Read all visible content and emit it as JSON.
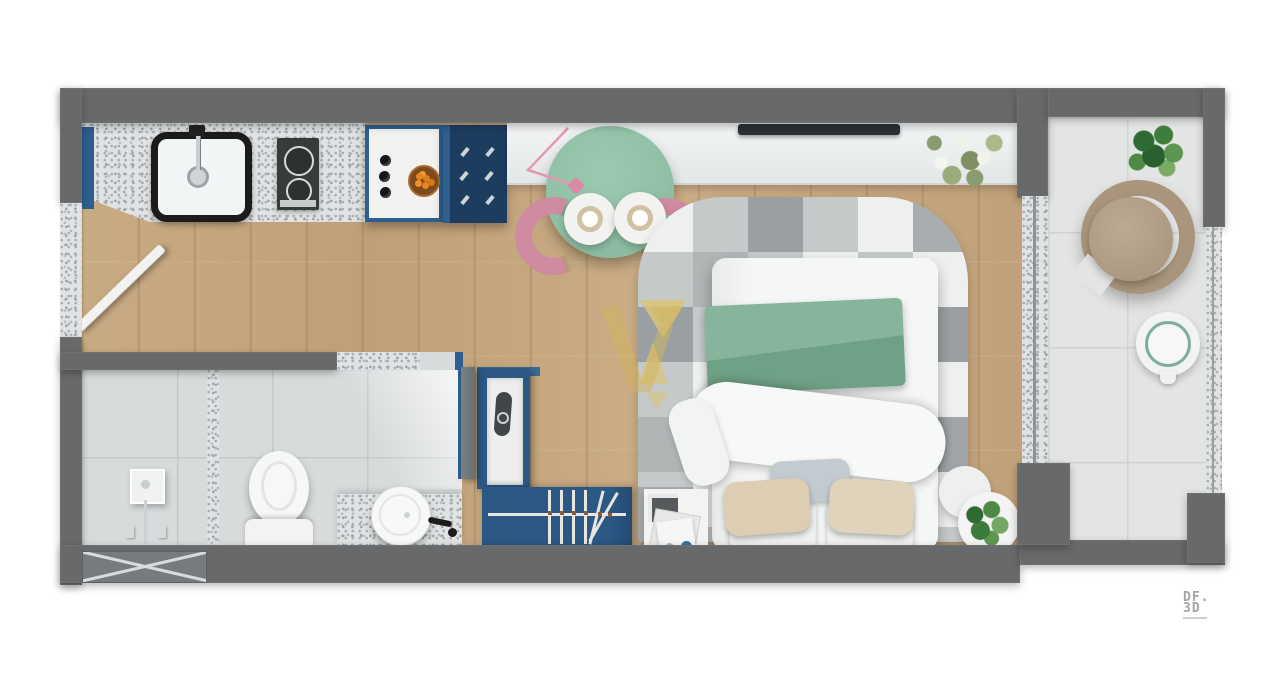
{
  "scene": {
    "type": "studio apartment floor plan, top-down 3D render",
    "rooms": [
      "kitchen",
      "dining area",
      "bedroom",
      "bathroom",
      "wardrobe corridor",
      "balcony"
    ],
    "furniture": [
      "kitchen sink with black faucet",
      "two-burner cooktop",
      "blue island unit with knobs and fruit bowl",
      "navy cabinet with handles",
      "round green dining table with two plates",
      "two pink chairs",
      "pink pendant lamp",
      "white console with TV",
      "white flower plant",
      "checkered gray rug with yellow triangles",
      "double bed with green blanket and pillows",
      "round bedside tables with plant",
      "magazine board",
      "blue wardrobe with hanger rail",
      "shelf with hair dryer",
      "shower set",
      "toilet",
      "granite counter with round washbasin and black faucet",
      "open entry door",
      "open bathroom door",
      "hatched window opening",
      "round rattan lounge chair",
      "round white side table",
      "balcony plant"
    ]
  },
  "logo": {
    "line1": "DF.",
    "line2": "3D"
  },
  "watermark": {
    "name": "yellow V brand watermark"
  },
  "colors": {
    "wall": "#67696b",
    "granite": "#e0e2e3",
    "wood": "#c6a87f",
    "bath_tile": "#d8dbdc",
    "balcony_tile": "#e3e5e4",
    "tile_line": "#cfd2d1",
    "navy": "#1d3d60",
    "blue": "#2e5f8e",
    "wardrobe_blue": "#2b5884",
    "table_green": "#8cbfa4",
    "chair_pink": "#cf8ba0",
    "lamp_pink": "#d98ba6",
    "blanket_green": "#7cac92",
    "rug_light": "#eef0f0",
    "rug_mid": "#c5c9ca",
    "rug_dark": "#9aa0a2",
    "rug_extra": "#b0b5b6",
    "rug_yellow": "#d9c478",
    "rattan": "#b5a28a",
    "rattan_dark": "#a8957c",
    "bed_white": "#f5f6f6",
    "beige": "#dccdb3",
    "gray_pillow": "#c3cad0",
    "plant_dark": "#2e6b33",
    "plant_mid": "#5d9650",
    "white_furniture": "#f4f5f4",
    "black": "#1c1c1c",
    "teal_ring": "#7fae9f",
    "console": "#edf0f1",
    "watermark_yellow": "#d2b45e",
    "logo_gray": "#a4a4a4"
  }
}
